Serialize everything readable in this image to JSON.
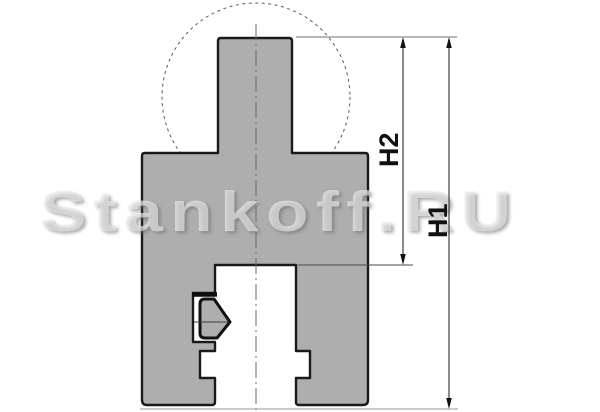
{
  "drawing": {
    "watermark": {
      "text": "Stankoff.RU"
    },
    "dimension_labels": {
      "h1": "H1",
      "h2": "H2"
    },
    "colors": {
      "background": "#ffffff",
      "part_fill": "#aeaeae",
      "part_outline": "#1a1a1a",
      "dashed_circle": "#5a5a5a",
      "centerline": "#6b6b6b",
      "dimension_line": "#3f3f3f",
      "extension_line": "#8c8c8c",
      "watermark_fill": "rgba(255,255,255,0.55)"
    }
  }
}
